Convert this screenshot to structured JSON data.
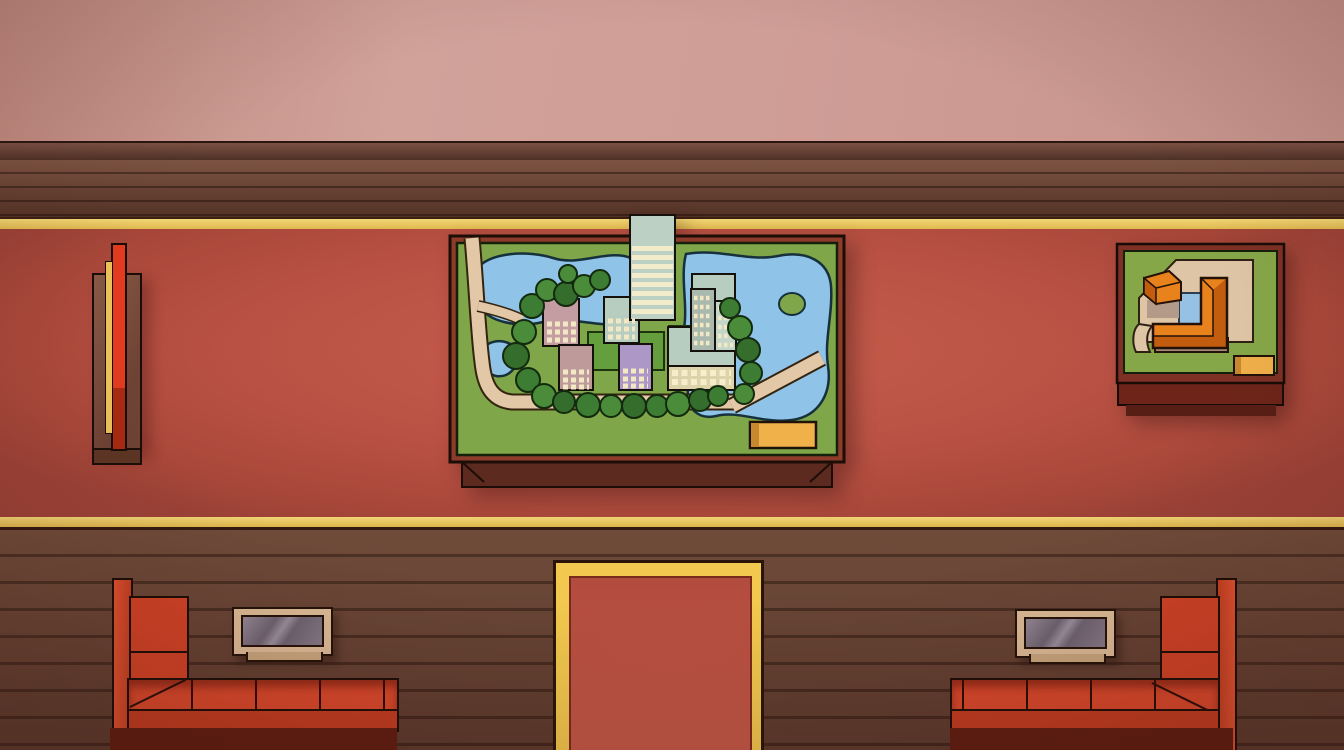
{
  "scene": {
    "name": "museum-gallery-hall",
    "width": 1344,
    "height": 750
  },
  "palette": {
    "wall": "#cf9d96",
    "wall_trim": "#4a2d22",
    "floor_upper": "#6f4838",
    "floor_lower": "#684435",
    "gold_stripe": "#eac963",
    "carpet": "#b85141",
    "entrance_border": "#f2c84e",
    "entrance_carpet": "#bd5446",
    "couch_red": "#d8482b",
    "couch_base": "#5f1d10",
    "table_frame": "#dcbb97",
    "table_glass": "#7d737f",
    "plant_leaf": "#7fb33c",
    "plant_pot": "#473956",
    "pedestal_gold": "#e7c65e",
    "pedestal_body": "#43302e",
    "coral": "#c06a20",
    "vase": "#4e3833",
    "window_frame": "#cf8551",
    "window_glass": "#c3bed3",
    "skyline": "#aaa4c4",
    "model_frame": "#8d3b2a",
    "model_grass": "#7fa648",
    "model_lake": "#8fc3e8",
    "model_road": "#e2c8a7",
    "model_plaque": "#f0b04a",
    "model_building_orange": "#e8821c",
    "wall_panel_red": "#d93020",
    "wall_panel_gold": "#ecc25a"
  },
  "windows": [
    {
      "x": 47,
      "y": -30,
      "w": 92,
      "h": 112,
      "silhouette": [
        {
          "l": 18,
          "t": 34,
          "w": 22,
          "h": 50
        },
        {
          "l": 44,
          "t": 22,
          "w": 30,
          "h": 62
        }
      ]
    },
    {
      "x": 300,
      "y": -32,
      "w": 93,
      "h": 110,
      "silhouette": [
        {
          "l": 14,
          "t": 24,
          "w": 24,
          "h": 66
        },
        {
          "l": 40,
          "t": 50,
          "w": 34,
          "h": 40
        }
      ]
    },
    {
      "x": 575,
      "y": -28,
      "w": 93,
      "h": 112,
      "silhouette": [
        {
          "l": 36,
          "t": 22,
          "w": 26,
          "h": 68
        },
        {
          "l": 26,
          "t": 76,
          "w": 48,
          "h": 14
        }
      ]
    },
    {
      "x": 845,
      "y": -30,
      "w": 90,
      "h": 110,
      "silhouette": [
        {
          "l": 8,
          "t": 30,
          "w": 20,
          "h": 60
        },
        {
          "l": 28,
          "t": 18,
          "w": 26,
          "h": 72
        },
        {
          "l": 54,
          "t": 40,
          "w": 18,
          "h": 50
        }
      ]
    },
    {
      "x": 1097,
      "y": -26,
      "w": 92,
      "h": 110,
      "silhouette": [
        {
          "l": 16,
          "t": 22,
          "w": 12,
          "h": 70
        },
        {
          "l": 34,
          "t": 44,
          "w": 36,
          "h": 48
        },
        {
          "l": 58,
          "t": 30,
          "w": 5,
          "h": 18
        }
      ]
    }
  ],
  "pedestals": [
    {
      "x": 197
    },
    {
      "x": 733
    },
    {
      "x": 1249
    }
  ],
  "vases": [
    {
      "x": 462,
      "y": 80
    },
    {
      "x": 982,
      "y": 82
    }
  ],
  "plants": [
    {
      "x": 6,
      "y": 558,
      "w": 108,
      "h": 196
    },
    {
      "x": 420,
      "y": 564,
      "w": 100,
      "h": 190
    },
    {
      "x": 782,
      "y": 564,
      "w": 100,
      "h": 190
    },
    {
      "x": 1236,
      "y": 556,
      "w": 108,
      "h": 196
    }
  ],
  "people": [
    {
      "name": "guide-green-vest",
      "x": 716,
      "y": 158,
      "w": 64,
      "h": 80,
      "z": 15,
      "hair": "#5a3a28",
      "skin": "#eab69a",
      "top": "#efe8d6",
      "vest": "#b3c244",
      "belt": "#1f8b80",
      "pants": "#39404f",
      "shoes": "#23252c",
      "reach": true
    },
    {
      "name": "visitor-bent-yellow",
      "x": 797,
      "y": 192,
      "w": 52,
      "h": 46,
      "z": 15,
      "bent": true,
      "hair": "#d9b852",
      "skin": "#eab69a",
      "top": "#e7c52b",
      "pants": "#9dbf51",
      "shoes": "#6b7f3a"
    },
    {
      "name": "visitor-red-hair",
      "x": 260,
      "y": 236,
      "w": 54,
      "h": 92,
      "z": 30,
      "hair": "#c33939",
      "skin": "#e6b197",
      "top": "#423c48",
      "pants": "#e2ac92",
      "shoes": "#1e1e22",
      "bag": "#efefed"
    },
    {
      "name": "visitor-white-rust",
      "x": 1036,
      "y": 208,
      "w": 50,
      "h": 84,
      "z": 30,
      "hair": "#e9cda9",
      "skin": "#e6b197",
      "top": "#f3f0e7",
      "pants": "#8c4b2b",
      "shoes": "#33231a"
    },
    {
      "name": "visitor-olive-hoodie",
      "x": 364,
      "y": 370,
      "w": 64,
      "h": 94,
      "z": 30,
      "hair": "#cfa98b",
      "skin": "#e6b197",
      "top": "#7d823d",
      "pants": "#74793a",
      "shoes": "#eae6dc"
    },
    {
      "name": "visitor-purple-sweater",
      "x": 872,
      "y": 330,
      "w": 58,
      "h": 94,
      "z": 30,
      "hair": "#c79878",
      "skin": "#e6b197",
      "top": "#9e7dc5",
      "pants": "#efece2",
      "shoes": "#7c5ba2",
      "vneck": "#f4f2ec"
    },
    {
      "name": "visitor-white-olive",
      "x": 488,
      "y": 526,
      "w": 54,
      "h": 100,
      "z": 30,
      "hair": "#e3cba2",
      "skin": "#e6b197",
      "top": "#f3f0e5",
      "pants": "#6e7030",
      "shoes": "#5d3d24"
    },
    {
      "name": "visitor-dark-coat",
      "x": 672,
      "y": 552,
      "w": 50,
      "h": 102,
      "z": 30,
      "hair": "#ddd4c6",
      "skin": "#e6b197",
      "top": "#2d3a45",
      "pants": "#2b3542",
      "shoes": "#dedede",
      "collar": "#f4f2ee"
    },
    {
      "name": "visitor-backpack",
      "x": 598,
      "y": 648,
      "w": 64,
      "h": 97,
      "z": 30,
      "hair": "#b3a99b",
      "skin": "#e6b197",
      "top": "#7f8d9b",
      "pants": "#8d7d6f",
      "shoes": "#3b352f",
      "pack": "#5d4a35"
    }
  ],
  "exhibits": {
    "city_model": {
      "x": 448,
      "y": 210,
      "w": 400,
      "h": 285,
      "grass": "#7fa648",
      "lake": "#8fc3e8",
      "buildings": [
        "striped-tower",
        "pink-block",
        "sage-block",
        "pink-house",
        "purple-block",
        "twin-towers",
        "cream-slab"
      ],
      "plaque": "#f0b04a"
    },
    "courtyard_model": {
      "x": 1113,
      "y": 238,
      "w": 175,
      "h": 185,
      "building": "#e8821c",
      "plaza": "#ddc5a5",
      "pool": "#96c1e5",
      "plaque": "#f0b04a"
    },
    "wall_panel": {
      "x": 92,
      "y": 243,
      "w": 46,
      "h": 217,
      "red": "#d93020",
      "gold": "#ecc25a"
    }
  },
  "furniture": {
    "couches": 2,
    "coffee_tables": 2,
    "entrance_carpet": {
      "x": 553,
      "y": 560,
      "w": 205,
      "h": 190
    }
  }
}
